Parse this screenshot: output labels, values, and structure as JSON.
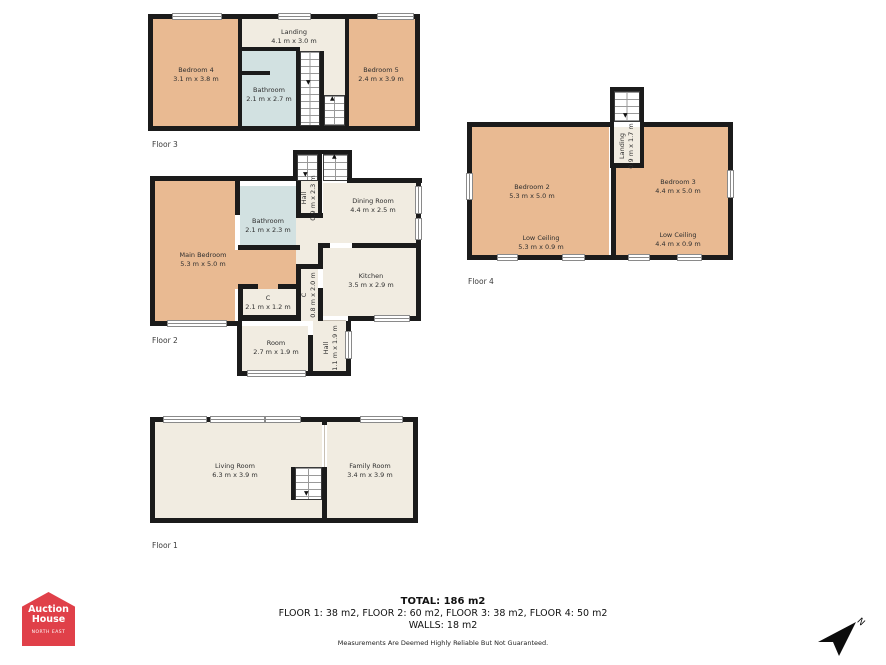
{
  "palette": {
    "wall": "#1b1b1b",
    "bedroom_fill": "#e9ba92",
    "general_fill": "#f1ece1",
    "bathroom_fill": "#d2e1e1",
    "logo_red": "#e04049"
  },
  "floors": [
    {
      "label": "Floor 1",
      "rooms": [
        {
          "name": "Living Room",
          "dims": "6.3 m x 3.9 m"
        },
        {
          "name": "Family Room",
          "dims": "3.4 m x 3.9 m"
        }
      ]
    },
    {
      "label": "Floor 2",
      "rooms": [
        {
          "name": "Main Bedroom",
          "dims": "5.3 m x 5.0 m"
        },
        {
          "name": "Bathroom",
          "dims": "2.1 m x 2.3 m"
        },
        {
          "name": "Hall",
          "dims": "0.9 m x 2.3 m"
        },
        {
          "name": "Dining Room",
          "dims": "4.4 m x 2.5 m"
        },
        {
          "name": "Kitchen",
          "dims": "3.5 m x 2.9 m"
        },
        {
          "name": "C",
          "dims": "2.1 m x 1.2 m"
        },
        {
          "name": "C",
          "dims": "0.8 m x 2.0 m"
        },
        {
          "name": "Room",
          "dims": "2.7 m x 1.9 m"
        },
        {
          "name": "Hall",
          "dims": "1.1 m x 1.9 m"
        }
      ]
    },
    {
      "label": "Floor 3",
      "rooms": [
        {
          "name": "Bedroom 4",
          "dims": "3.1 m x 3.8 m"
        },
        {
          "name": "Landing",
          "dims": "4.1 m x 3.0 m"
        },
        {
          "name": "Bedroom 5",
          "dims": "2.4 m x 3.9 m"
        },
        {
          "name": "Bathroom",
          "dims": "2.1 m x 2.7 m"
        }
      ]
    },
    {
      "label": "Floor 4",
      "rooms": [
        {
          "name": "Bedroom 2",
          "dims": "5.3 m x 5.0 m"
        },
        {
          "name": "Bedroom 3",
          "dims": "4.4 m x 5.0 m"
        },
        {
          "name": "Landing",
          "dims": "0.9 m x 1.7 m"
        },
        {
          "name": "Low Ceiling",
          "dims": "5.3 m x 0.9 m"
        },
        {
          "name": "Low Ceiling",
          "dims": "4.4 m x 0.9 m"
        }
      ]
    }
  ],
  "summary": {
    "total": "TOTAL: 186 m2",
    "floors_line": "FLOOR 1: 38 m2, FLOOR 2: 60 m2, FLOOR 3: 38 m2, FLOOR 4: 50 m2",
    "walls": "WALLS: 18 m2",
    "disclaimer": "Measurements Are Deemed Highly Reliable But Not Guaranteed."
  },
  "logo": {
    "line1": "Auction",
    "line2": "House",
    "subtext": "NORTH EAST"
  },
  "compass": {
    "label": "N"
  }
}
